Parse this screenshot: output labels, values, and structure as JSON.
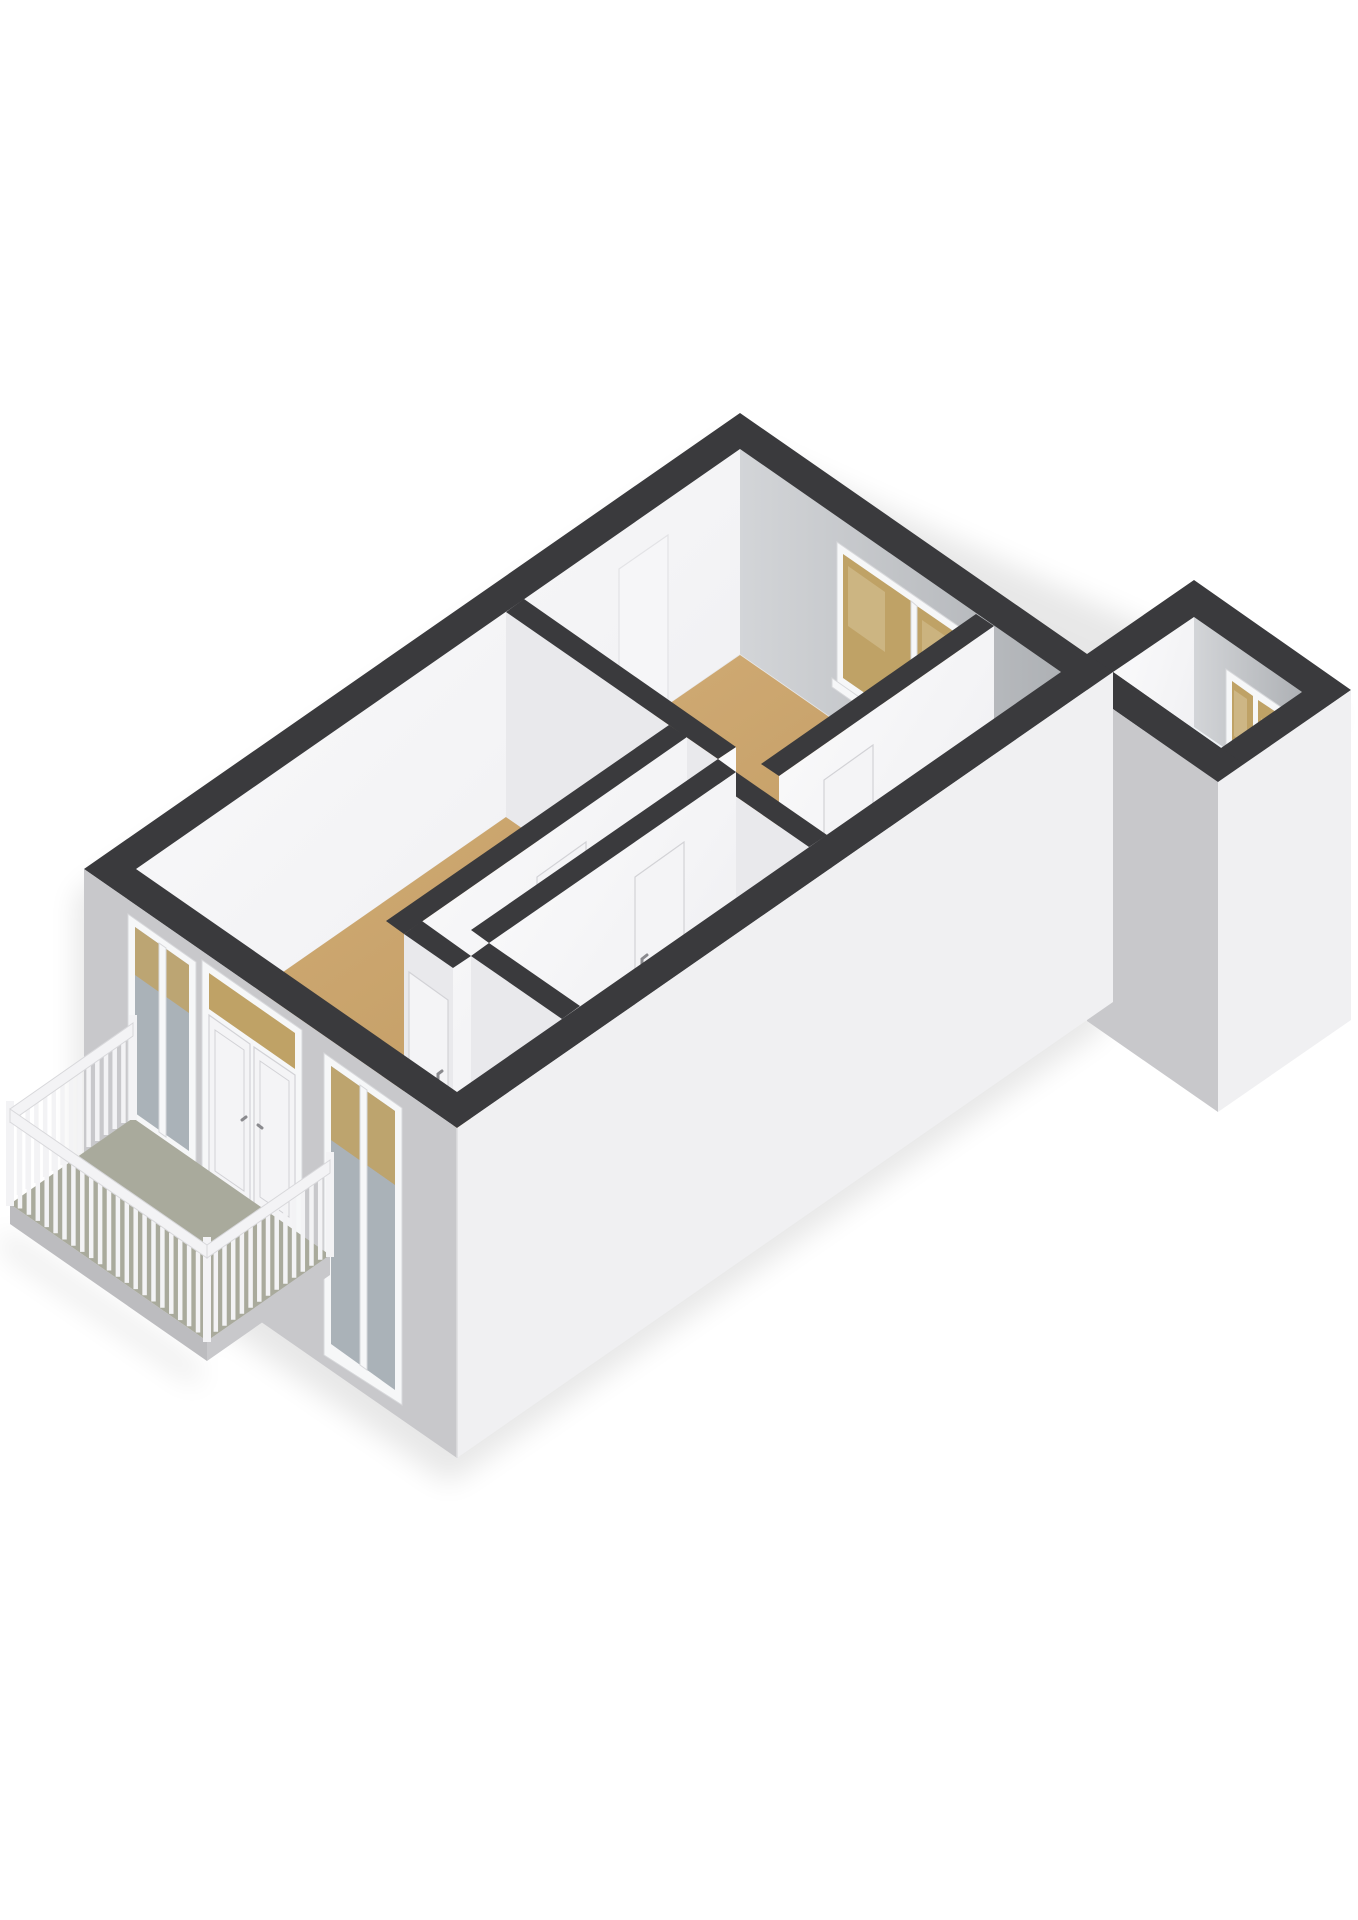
{
  "app": {
    "view_label": "3d-floor-plan-render",
    "background": "#ffffff"
  },
  "colors": {
    "bg": "#ffffff",
    "wallTop": "#3a3a3d",
    "intBrightA": "#fbfbfc",
    "intBrightB": "#ededf0",
    "intGrayA": "#d3d5d8",
    "intGrayB": "#aeb1b5",
    "sideFace": "#e9e9ec",
    "extGray": "#c8c8cb",
    "extWhite": "#f0f0f2",
    "floorTanA": "#d2ac76",
    "floorTanB": "#bf9a61",
    "bathA": "#ccd5da",
    "bathB": "#b7c2c9",
    "balcony": "#a9aa9c",
    "wood": "#c9ad82",
    "woodDark": "#b4976c",
    "frame": "#f6f7f8",
    "frameShadow": "#d7d8db",
    "glassTan": "#bfa266",
    "glassLight": "#d9c79e",
    "glassCool": "#aab2b8",
    "leaf": "#f4f4f6",
    "leafLine": "#d2d2d6",
    "handle": "#8a8a8e",
    "rail": "#f3f3f5",
    "railShade": "#d8d8db"
  },
  "scene": {
    "projection": "isometric",
    "rooms": [
      {
        "name": "bedroom-top",
        "floor": "wood"
      },
      {
        "name": "living-room",
        "floor": "wood"
      },
      {
        "name": "hallway",
        "floor": "wood"
      },
      {
        "name": "bedroom-right",
        "floor": "wood"
      },
      {
        "name": "room-bottom",
        "floor": "wood"
      },
      {
        "name": "bathroom-wing",
        "floor": "tile"
      }
    ],
    "fixtures": [
      "double-window-bedroom-top",
      "double-window-bathroom",
      "vanity-two-sinks",
      "shower-glass-panel",
      "shower-head",
      "balcony-with-balustrade",
      "french-doors-balcony",
      "tall-window-balcony",
      "tall-window-bottom-room",
      "interior-doors-with-handles"
    ],
    "door_count": 5,
    "window_count": 4
  }
}
